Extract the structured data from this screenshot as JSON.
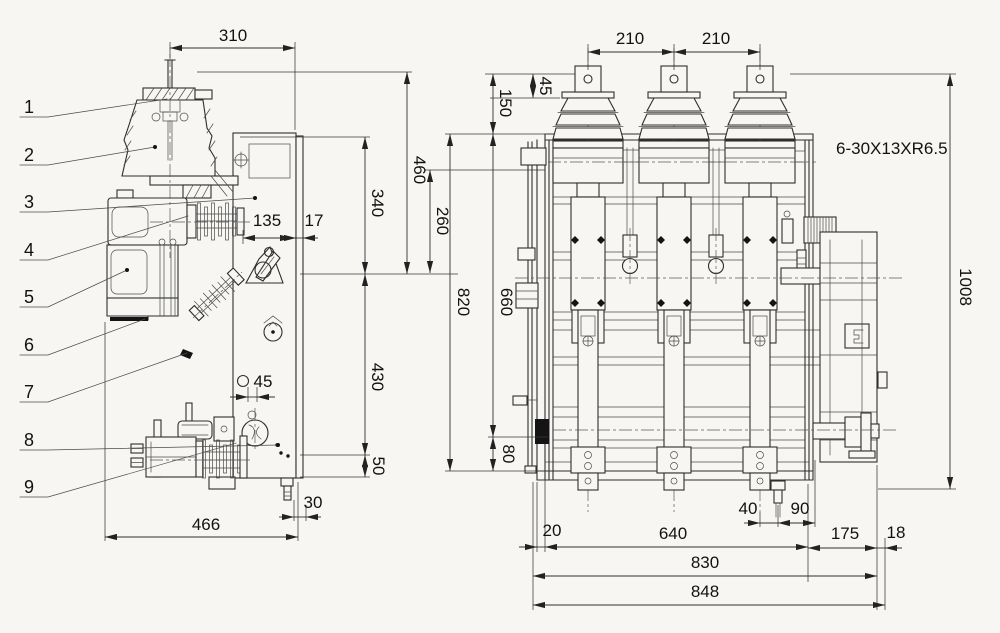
{
  "drawing": {
    "kind": "engineering dimensional drawing, two orthographic views",
    "paper_color": "#f7f6f3",
    "ink_color": "#2e2e2e"
  },
  "side_view": {
    "callouts": [
      "1",
      "2",
      "3",
      "4",
      "5",
      "6",
      "7",
      "8",
      "9"
    ],
    "dims": {
      "top_width": "310",
      "height_to_terminal": "460",
      "height_upper": "340",
      "insulator_length": "135",
      "panel_offset": "17",
      "height_lower": "430",
      "hole_diameter": "45",
      "base_drop": "50",
      "stud_offset": "30",
      "base_width": "466"
    }
  },
  "front_view": {
    "dims": {
      "pole_pitch_left": "210",
      "pole_pitch_right": "210",
      "terminal_height": "45",
      "bushing_top_height": "150",
      "shaft_offset": "260",
      "frame_height": "820",
      "inner_height": "660",
      "foot_height": "80",
      "overall_height": "1008",
      "left_edge_offset": "20",
      "frame_width": "640",
      "drain_offset_a": "40",
      "drain_offset_b": "90",
      "mechanism_width": "175",
      "mechanism_edge": "18",
      "mounting_span": "830",
      "overall_width": "848"
    },
    "mounting_note": "6-30X13XR6.5"
  }
}
